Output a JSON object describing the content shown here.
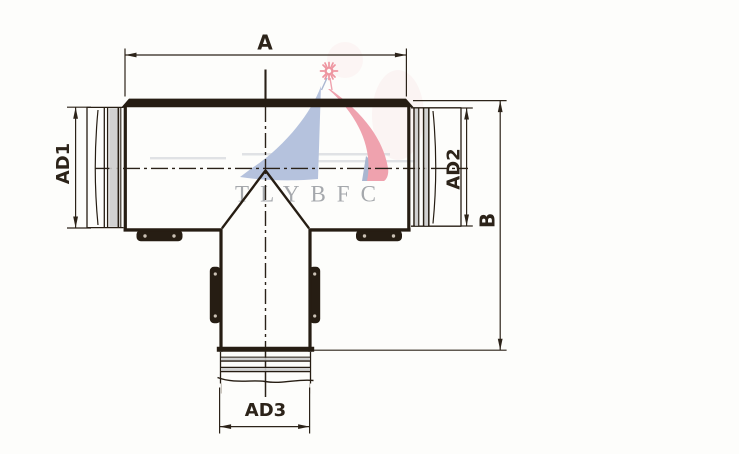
{
  "labels": {
    "a": "A",
    "b": "B",
    "ad1": "AD1",
    "ad2": "AD2",
    "ad3": "AD3"
  },
  "watermark": {
    "text": "TLYBFC",
    "colors": {
      "sun": "#ee95a0",
      "sail_blue": "#b5c2dd",
      "sail_blue_dark": "#a9b6d0",
      "sail_red": "#efa2ae",
      "text": "#a5a8ac",
      "wake": "#b9bfc9"
    }
  },
  "colors": {
    "line": "#261d13",
    "dim": "#2c2319",
    "centerline": "#2a2118",
    "rib_gray": "#cccccc",
    "rivet": "#cbc1b5",
    "faint": "#bdb7ae",
    "background": "#fdfdfb"
  }
}
